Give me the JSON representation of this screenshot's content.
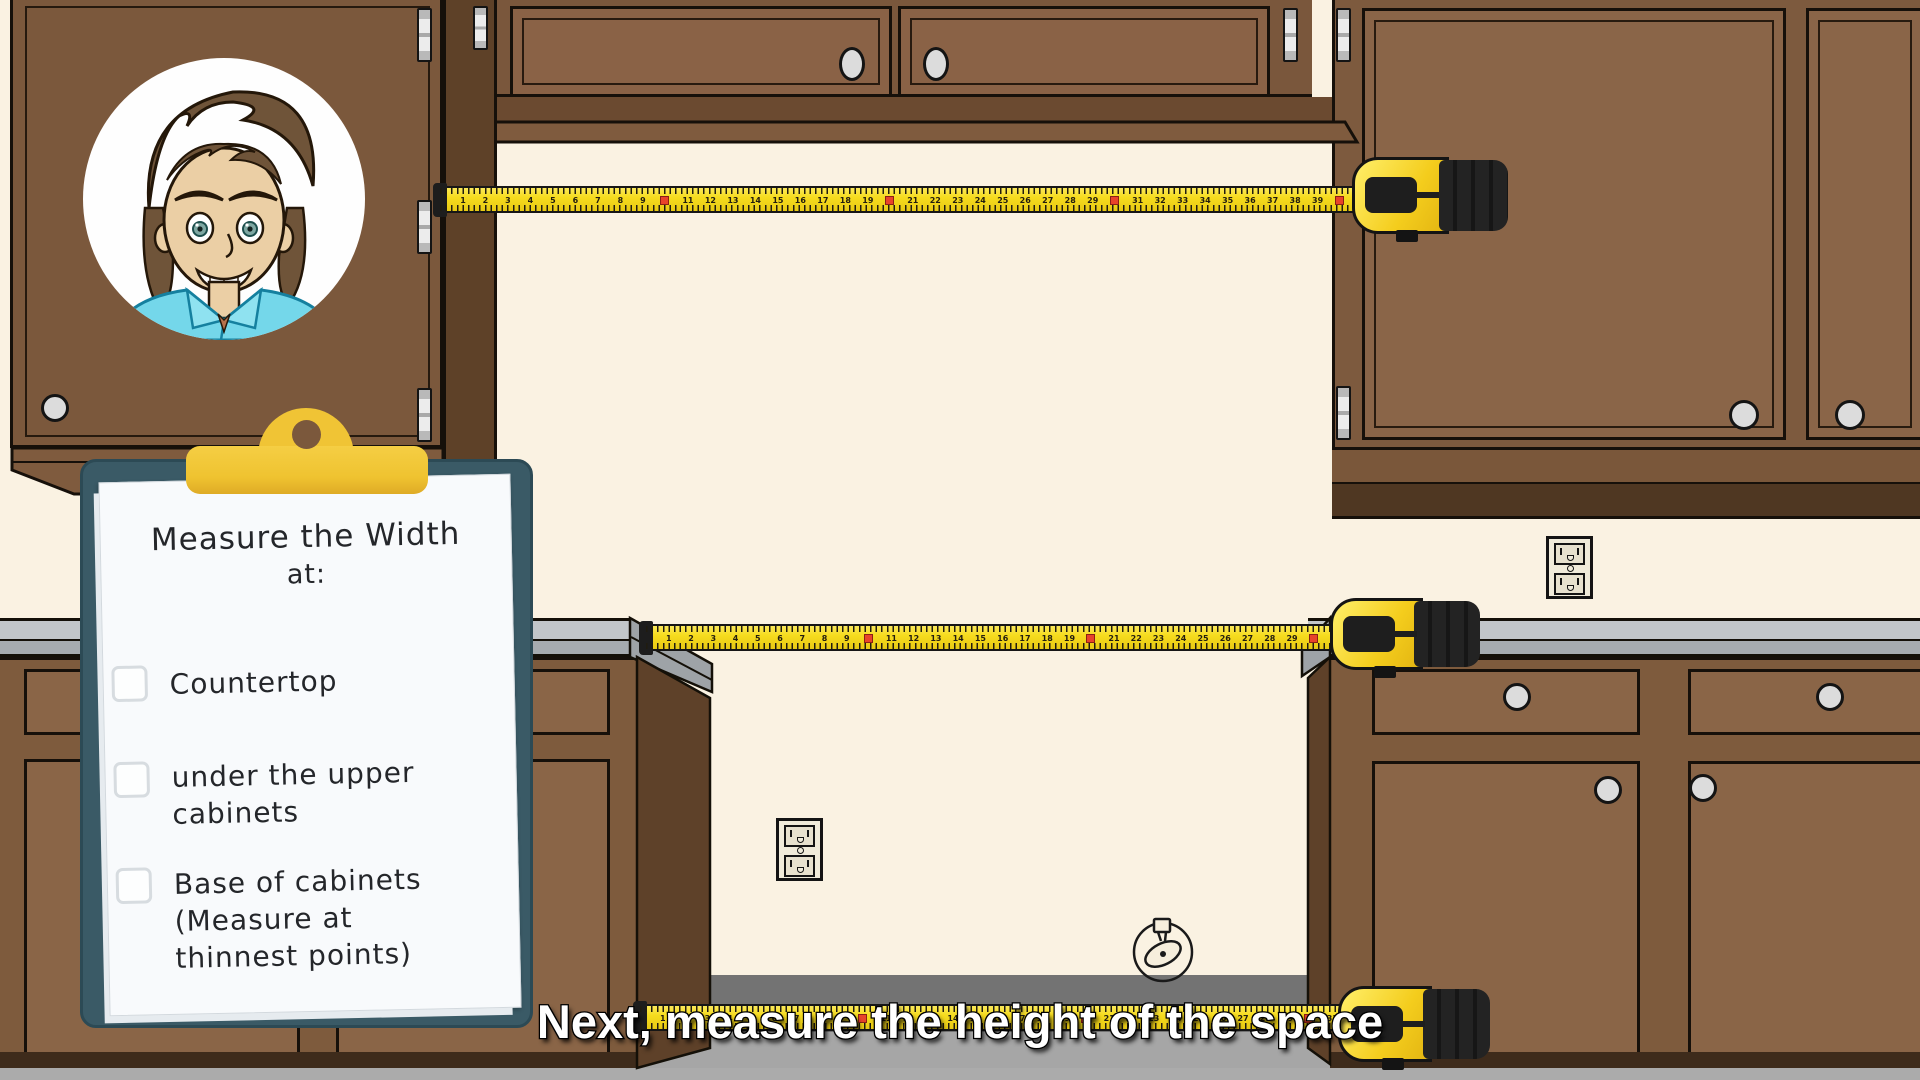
{
  "caption": {
    "text": "Next, measure the height of the space"
  },
  "clipboard": {
    "title": {
      "line1": "Measure the Width",
      "line2": "at:"
    },
    "items": [
      {
        "id": "countertop",
        "checked": false,
        "line1": "Countertop"
      },
      {
        "id": "under-upper-cabinets",
        "checked": false,
        "line1": "under the upper",
        "line2": "cabinets"
      },
      {
        "id": "base-of-cabinets",
        "checked": false,
        "line1": "Base of cabinets",
        "line2": "(Measure at",
        "line3": "thinnest points)"
      }
    ]
  },
  "tapes": {
    "top": {
      "units": 41,
      "red_every": 10
    },
    "middle": {
      "units": 31,
      "red_every": 10
    },
    "bottom": {
      "units": 32,
      "red_every": 10
    }
  },
  "icons": {
    "avatar": "presenter-avatar",
    "outlet": "power-outlet",
    "gas_hookup": "gas-hookup-valve",
    "tape": "tape-measure"
  },
  "colors": {
    "wall": "#FAF2E2",
    "cabinet_face": "#7B583C",
    "cabinet_door": "#8A6246",
    "cabinet_dark_band": "#4F3722",
    "countertop": "#BDC1C4",
    "clipboard_board": "#3A5A66",
    "clip_yellow": "#F0C435",
    "tape_yellow": "#F6DC1E",
    "tape_red_mark": "#E8432A",
    "floor_dark": "#737373",
    "floor_light": "#A9A9A9"
  }
}
